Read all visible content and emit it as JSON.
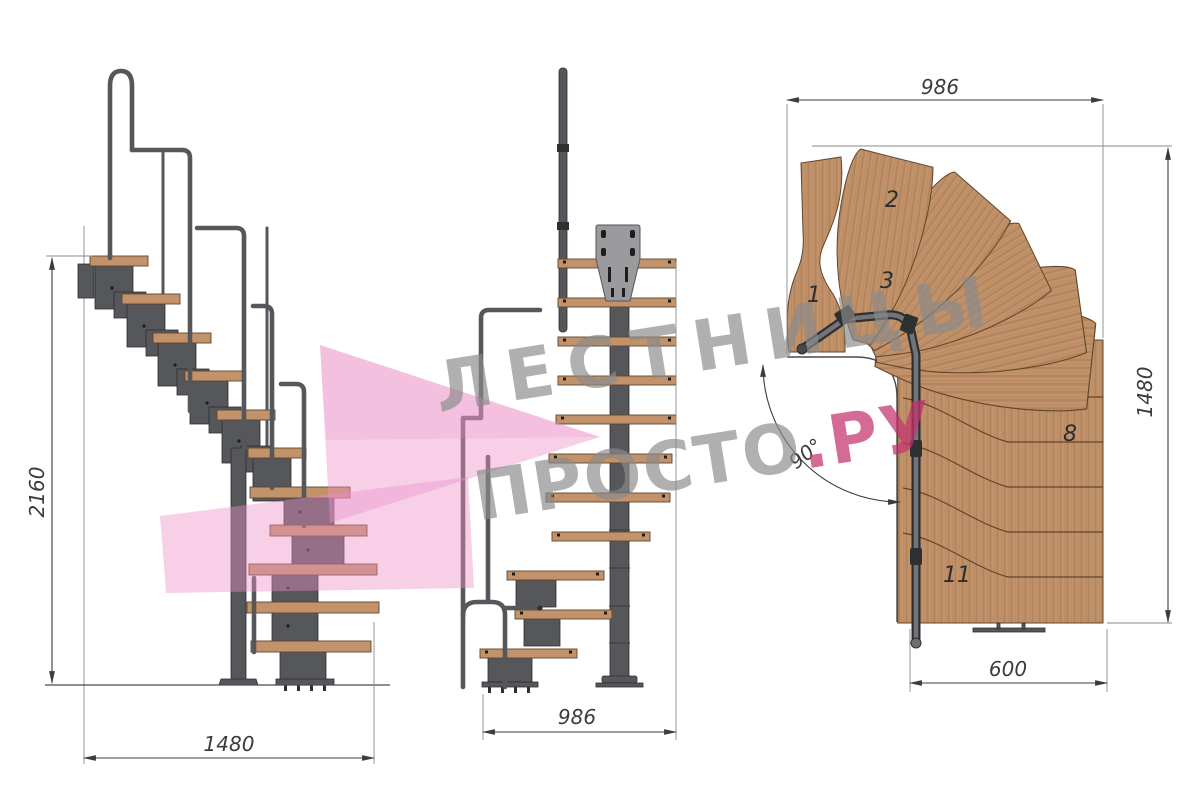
{
  "document": {
    "type": "staircase-technical-drawing",
    "background": "#ffffff"
  },
  "side_view": {
    "title": "side-elevation",
    "height_dim": "2160",
    "width_dim": "1480"
  },
  "front_view": {
    "title": "front-elevation",
    "width_dim": "986"
  },
  "plan_view": {
    "title": "top-plan",
    "top_dim": "986",
    "right_dim": "1480",
    "bottom_dim": "600",
    "angle_dim": "90°",
    "tread_labels": [
      {
        "n": "1"
      },
      {
        "n": "2"
      },
      {
        "n": "3"
      },
      {
        "n": "8"
      },
      {
        "n": "11"
      }
    ]
  },
  "watermark": {
    "line1": "ЛЕСТНИЦЫ",
    "line2_gray": "ПРОСТО",
    "line2_accent": ".РУ"
  },
  "colors": {
    "background": "#ffffff",
    "wood_face": "#c2936a",
    "wood_top": "#d7ae80",
    "wood_edge": "#5f452c",
    "metal": "#56575b",
    "metal_dark": "#2e2f31",
    "plate": "#9b9b9d",
    "dim": "#3c3c3c",
    "wm_gray": "#8a8a8a",
    "wm_accent": "#c2326e",
    "logo_pink": "#ec8fc7"
  }
}
